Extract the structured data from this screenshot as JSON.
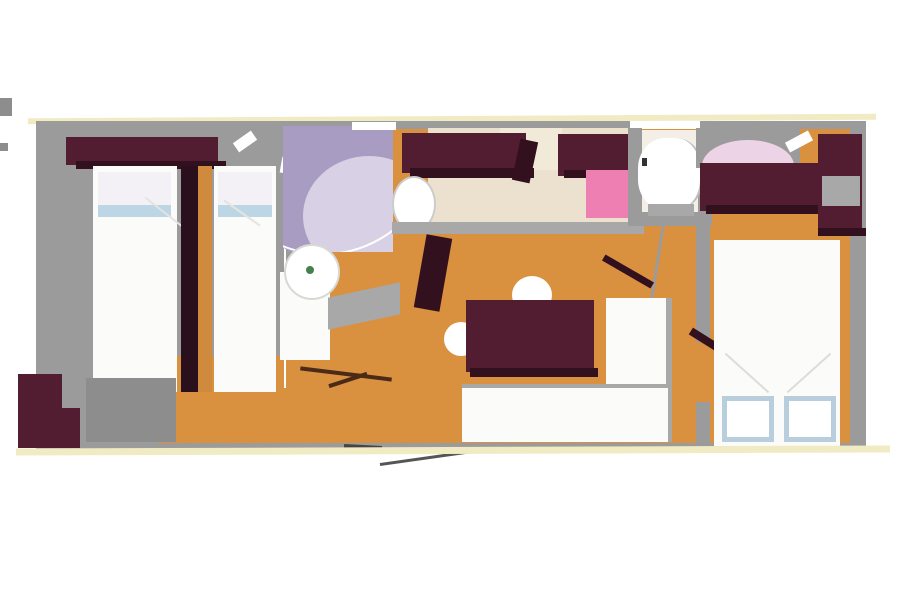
{
  "image_type": "mobile-home-floor-plan",
  "palette": {
    "wall": "#9b9b9b",
    "wallDark": "#8d8d8d",
    "floor": "#d9913f",
    "floorSoft": "#cf8a3e",
    "maroon": "#521d30",
    "maroonDark": "#33101e",
    "bedWhite": "#fbfbf9",
    "pillow": "#bcd6e6",
    "pillowPale": "#f3f1f6",
    "pillowBorder": "#b9cedd",
    "shower": "#a89cc3",
    "showerLight": "#d8d0e4",
    "pink": "#ee7fb3",
    "pinkLight": "#ecd4e6",
    "counter": "#ece1cf",
    "counterLight": "#f2ead9",
    "outline": "#f1ebc4",
    "green": "#47804f",
    "lineGray": "#a8a8a8",
    "doorWood": "#4b2a18",
    "white": "#ffffff"
  },
  "rooms": [
    {
      "name": "twin-bedroom",
      "furniture": [
        "overhead-cabinet",
        "single-bed",
        "single-bed",
        "bedside-divider"
      ]
    },
    {
      "name": "bathroom",
      "furniture": [
        "corner-shower",
        "washbasin",
        "vanity-cabinet",
        "door"
      ]
    },
    {
      "name": "kitchen",
      "furniture": [
        "overhead-cabinet",
        "overhead-cabinet",
        "worktop",
        "sink",
        "hob"
      ]
    },
    {
      "name": "wc",
      "furniture": [
        "toilet",
        "door"
      ]
    },
    {
      "name": "master-bedroom",
      "furniture": [
        "wardrobe",
        "wardrobe",
        "dressing-shelf",
        "double-bed",
        "pillow",
        "pillow",
        "door"
      ]
    },
    {
      "name": "living-dining",
      "furniture": [
        "dining-table",
        "bench-seat",
        "bench-seat",
        "stool",
        "stool",
        "entry-door"
      ]
    },
    {
      "name": "hall-steps",
      "furniture": [
        "storage-steps"
      ]
    }
  ]
}
